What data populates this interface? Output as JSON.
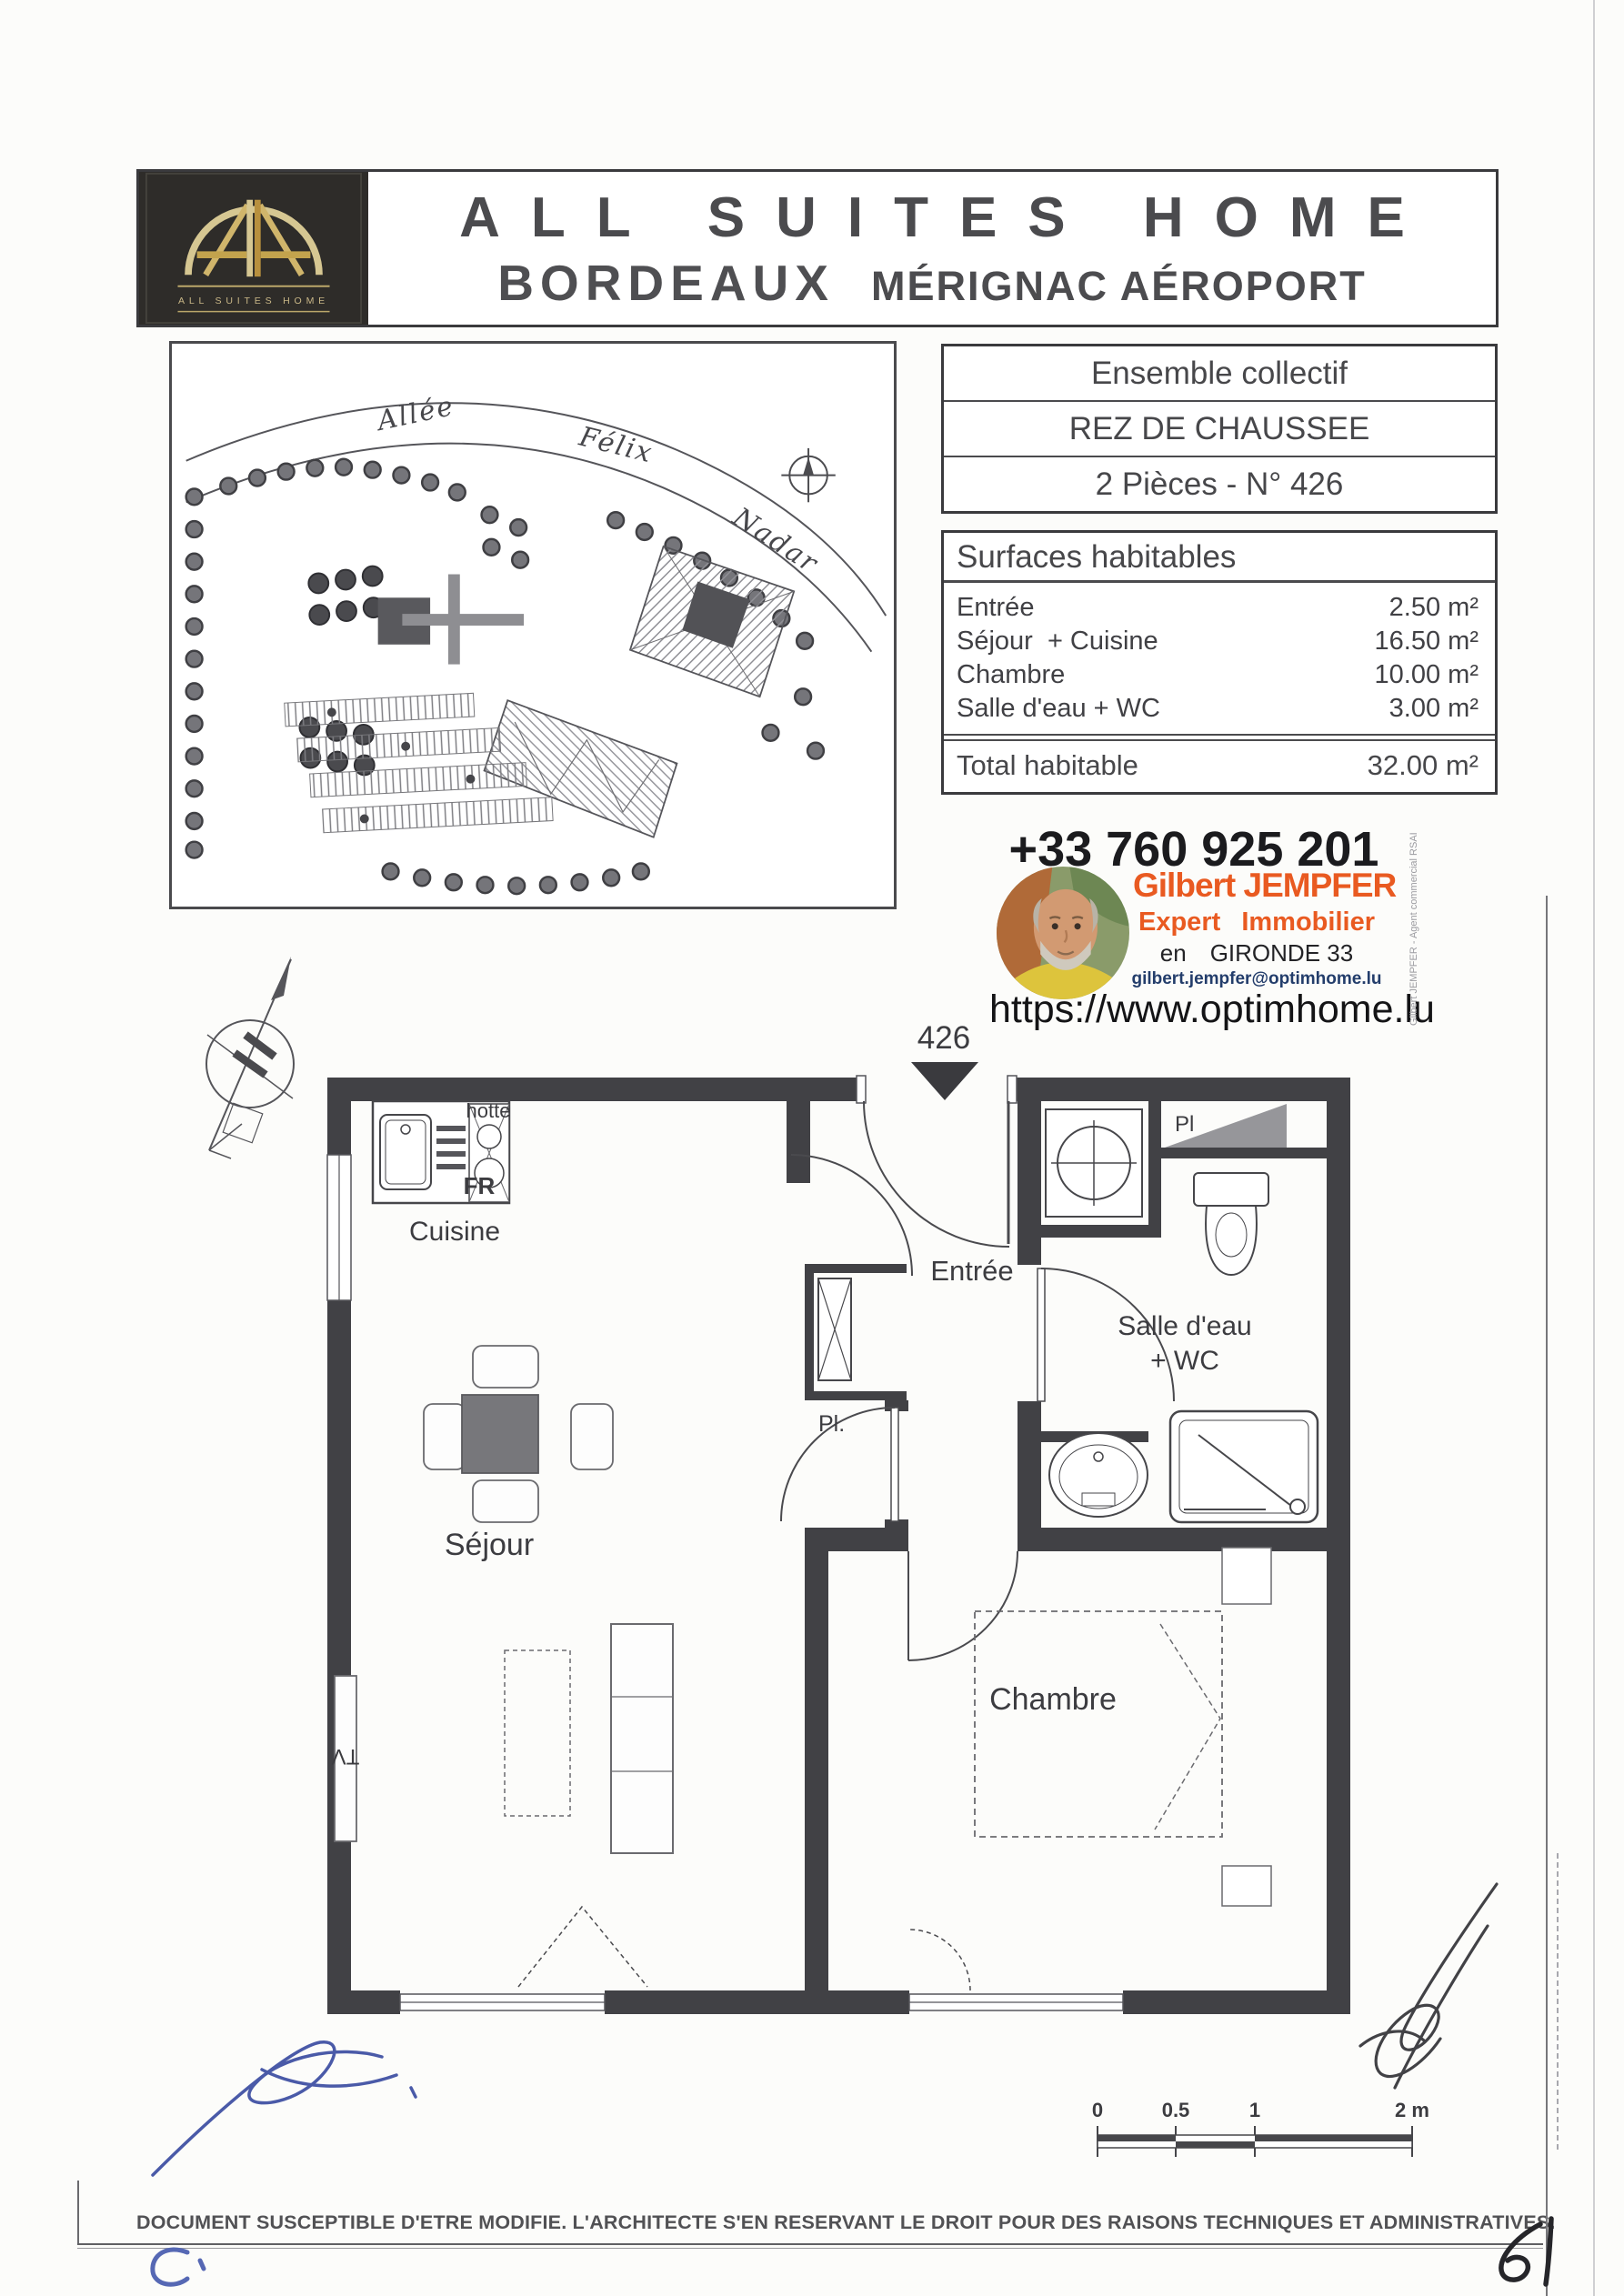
{
  "header": {
    "logo": {
      "caption": "ALL SUITES HOME"
    },
    "title_line1": "ALL SUITES HOME",
    "title_city": "BORDEAUX",
    "title_location": "MÉRIGNAC AÉROPORT"
  },
  "unit_info": {
    "rows": [
      "Ensemble collectif",
      "REZ DE CHAUSSEE",
      "2 Pièces - N° 426"
    ]
  },
  "surfaces": {
    "title": "Surfaces habitables",
    "rows": [
      {
        "label": "Entrée",
        "value": "2.50 m²"
      },
      {
        "label": "Séjour  + Cuisine",
        "value": "16.50 m²"
      },
      {
        "label": "Chambre",
        "value": "10.00 m²"
      },
      {
        "label": "Salle d'eau + WC",
        "value": "3.00 m²"
      }
    ],
    "total": {
      "label": "Total habitable",
      "value": "32.00 m²"
    }
  },
  "contact": {
    "phone": "+33 760 925 201",
    "name": "Gilbert JEMPFER",
    "role_left": "Expert",
    "role_right": "Immobilier",
    "region_prefix": "en",
    "region": "GIRONDE 33",
    "email": "gilbert.jempfer@optimhome.lu",
    "website": "https://www.optimhome.lu",
    "side_note": "Gilbert JEMPFER - Agent commercial RSAI"
  },
  "site_plan": {
    "street_word1": "Allée",
    "street_word2": "Félix",
    "street_word3": "Nadar"
  },
  "floor_plan": {
    "unit_number": "426",
    "labels": {
      "cuisine": "Cuisine",
      "hood": "hotte",
      "fridge": "FR",
      "entree": "Entrée",
      "placard_small": "Pl",
      "placard": "Pl.",
      "bath_line1": "Salle d'eau",
      "bath_line2": "+ WC",
      "sejour": "Séjour",
      "tv": "TV",
      "chambre": "Chambre"
    }
  },
  "scale_bar": {
    "t0": "0",
    "t05": "0.5",
    "t1": "1",
    "t2": "2 m"
  },
  "footer": {
    "disclaimer": "DOCUMENT SUSCEPTIBLE D'ETRE MODIFIE. L'ARCHITECTE S'EN RESERVANT LE DROIT POUR DES RAISONS TECHNIQUES ET ADMINISTRATIVES."
  },
  "annotations": {
    "page_number": "61"
  }
}
